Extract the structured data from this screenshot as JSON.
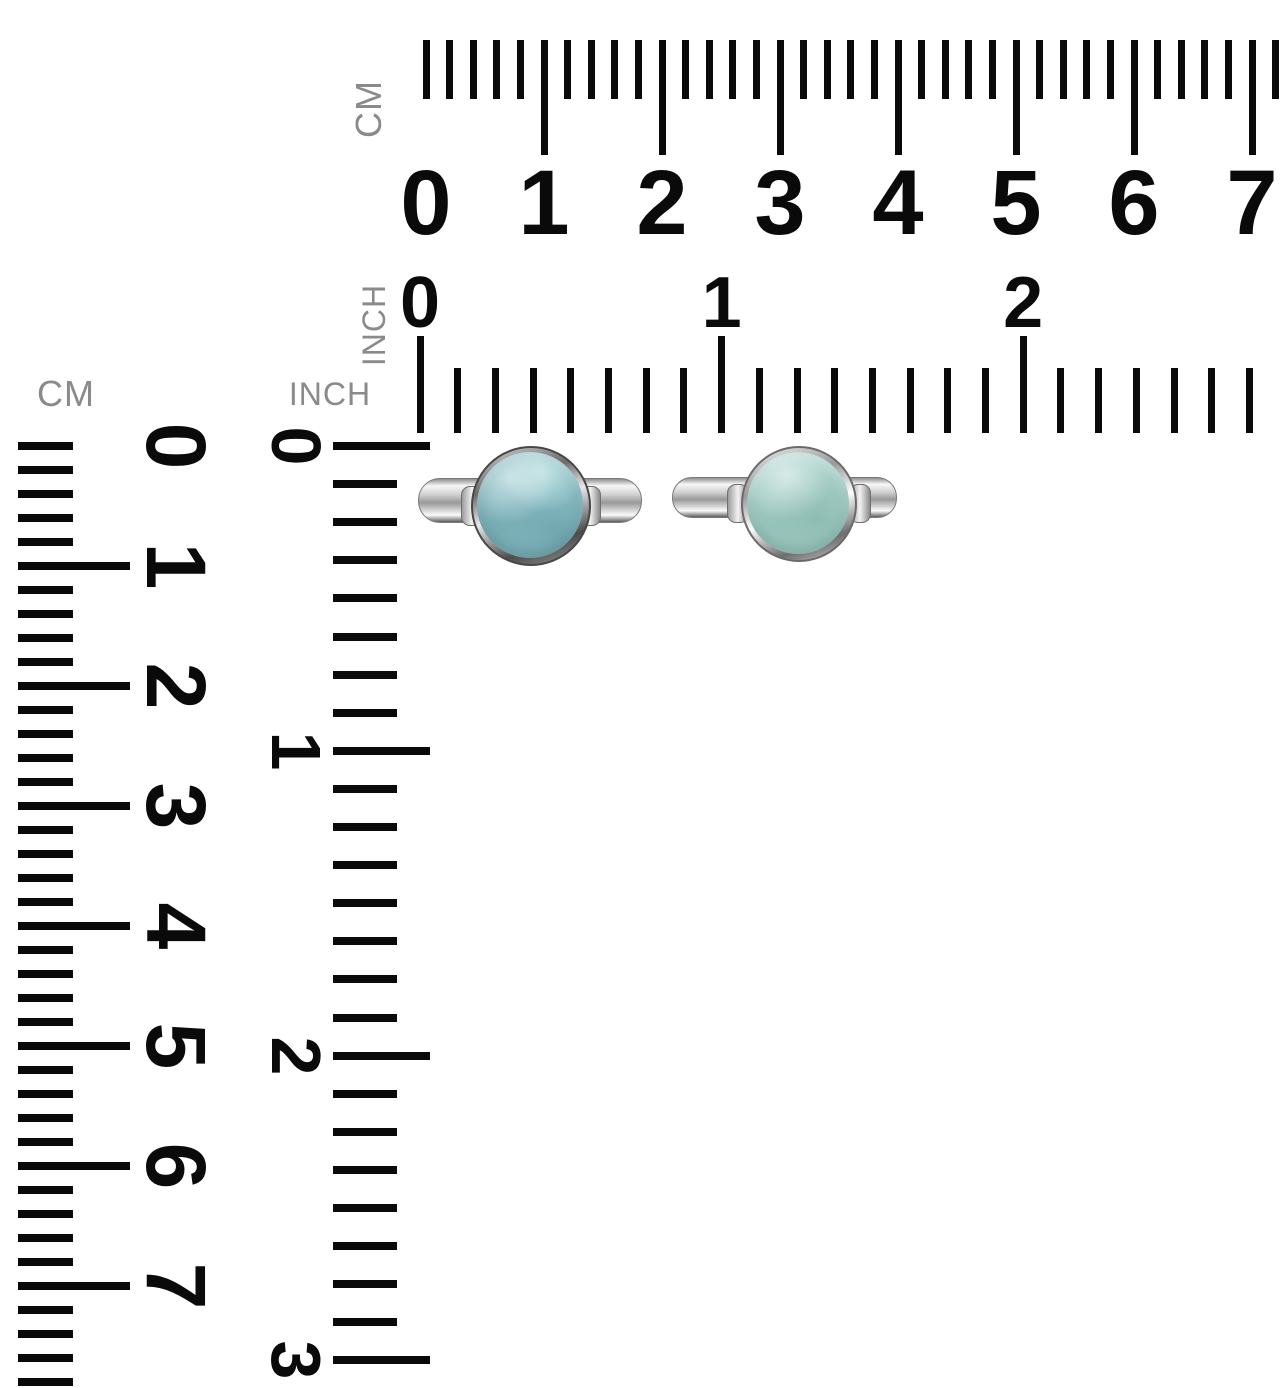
{
  "image": {
    "width": 1284,
    "height": 1388,
    "background": "#ffffff"
  },
  "colors": {
    "tick": "#0a0a0a",
    "number": "#0a0a0a",
    "unit_label": "#8a8a8a",
    "silver_highlight": "#f7f7f7",
    "silver_mid": "#9b9b9b",
    "silver_shadow": "#5f5f5f",
    "left_stone": "#8ec1c8",
    "right_stone": "#a7d0c8"
  },
  "rulers": {
    "top_cm": {
      "unit": "CM",
      "numbers": [
        "0",
        "1",
        "2",
        "3",
        "4",
        "5",
        "6",
        "7"
      ]
    },
    "top_inch": {
      "unit": "INCH",
      "numbers": [
        "0",
        "1",
        "2"
      ]
    },
    "left_cm": {
      "unit": "CM",
      "numbers": [
        "0",
        "1",
        "2",
        "3",
        "4",
        "5",
        "6",
        "7"
      ]
    },
    "left_inch": {
      "unit": "INCH",
      "numbers": [
        "0",
        "1",
        "2",
        "3"
      ]
    }
  },
  "products": {
    "left_ring": {
      "description": "silver ring with round aquamarine cabochon, mottled teal stone",
      "stone_color": "#8ec1c8",
      "metal": "silver"
    },
    "right_ring": {
      "description": "silver ring with round aquamarine cabochon, pale seafoam stone",
      "stone_color": "#a7d0c8",
      "metal": "silver"
    }
  }
}
